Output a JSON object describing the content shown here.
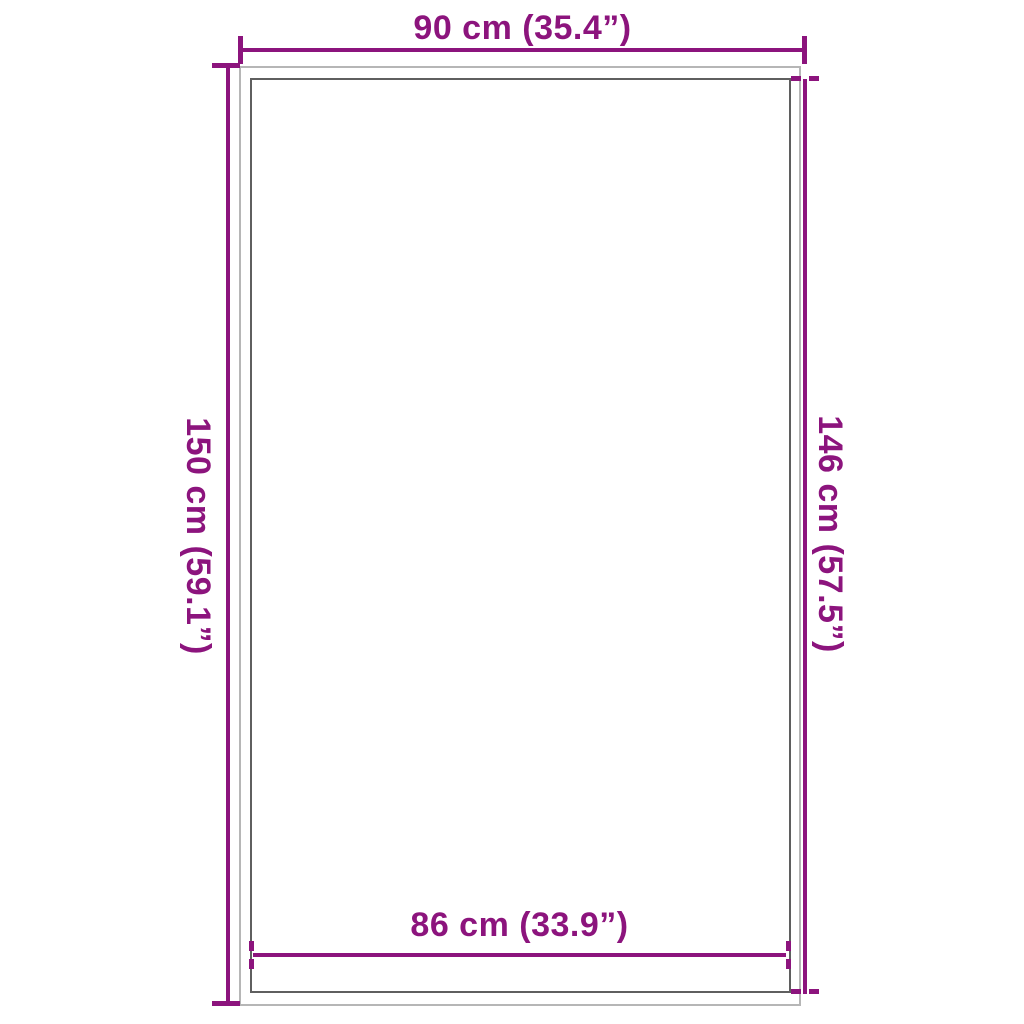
{
  "diagram": {
    "type": "product-dimension-diagram",
    "dimensions": {
      "top": "90 cm (35.4”)",
      "left": "150 cm (59.1”)",
      "right": "146 cm (57.5”)",
      "bottom": "86 cm (33.9”)"
    }
  },
  "colors": {
    "dimension_line": "#8c147d",
    "outer_rect_border": "#b6b6b6",
    "inner_rect_border": "#5f5f5f",
    "background": "#ffffff"
  }
}
